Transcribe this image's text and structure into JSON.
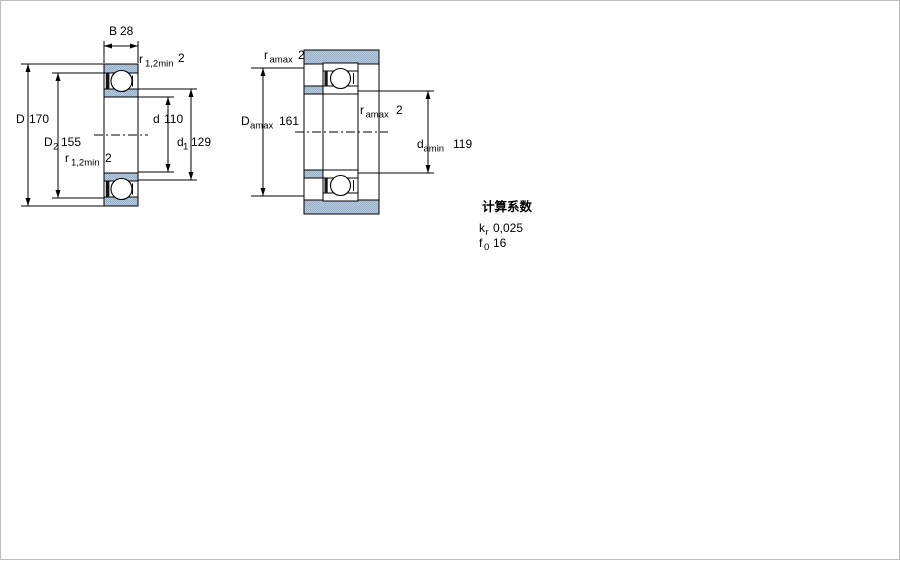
{
  "colors": {
    "background": "#ffffff",
    "border": "#bcbcbc",
    "line": "#000000",
    "steel_fill_base": "#b7cde4",
    "steel_fill_dot": "#98aec5",
    "seal": "#141414"
  },
  "views": {
    "cross_section": {
      "dims": {
        "B": {
          "symbol": "B",
          "value": "28"
        },
        "r12_top": {
          "symbol": "r",
          "sub": "1,2min",
          "value": "2"
        },
        "D": {
          "symbol": "D",
          "value": "170"
        },
        "D2": {
          "symbol": "D",
          "sub": "2",
          "value": "155"
        },
        "r12_bottom": {
          "symbol": "r",
          "sub": "1,2min",
          "value": "2"
        },
        "d": {
          "symbol": "d",
          "value": "110"
        },
        "d1": {
          "symbol": "d",
          "sub": "1",
          "value": "129"
        }
      }
    },
    "mounting": {
      "dims": {
        "ra_top": {
          "symbol": "r",
          "sub": "amax",
          "value": "2"
        },
        "Da": {
          "symbol": "D",
          "sub": "amax",
          "value": "161"
        },
        "ra_inner": {
          "symbol": "r",
          "sub": "amax",
          "value": "2"
        },
        "da": {
          "symbol": "d",
          "sub": "amin",
          "value": "119"
        }
      }
    }
  },
  "calculation_factors": {
    "title": "计算系数",
    "rows": [
      {
        "symbol": "k",
        "sub": "r",
        "value": "0,025"
      },
      {
        "symbol": "f",
        "sub": "0",
        "value": "16"
      }
    ]
  }
}
